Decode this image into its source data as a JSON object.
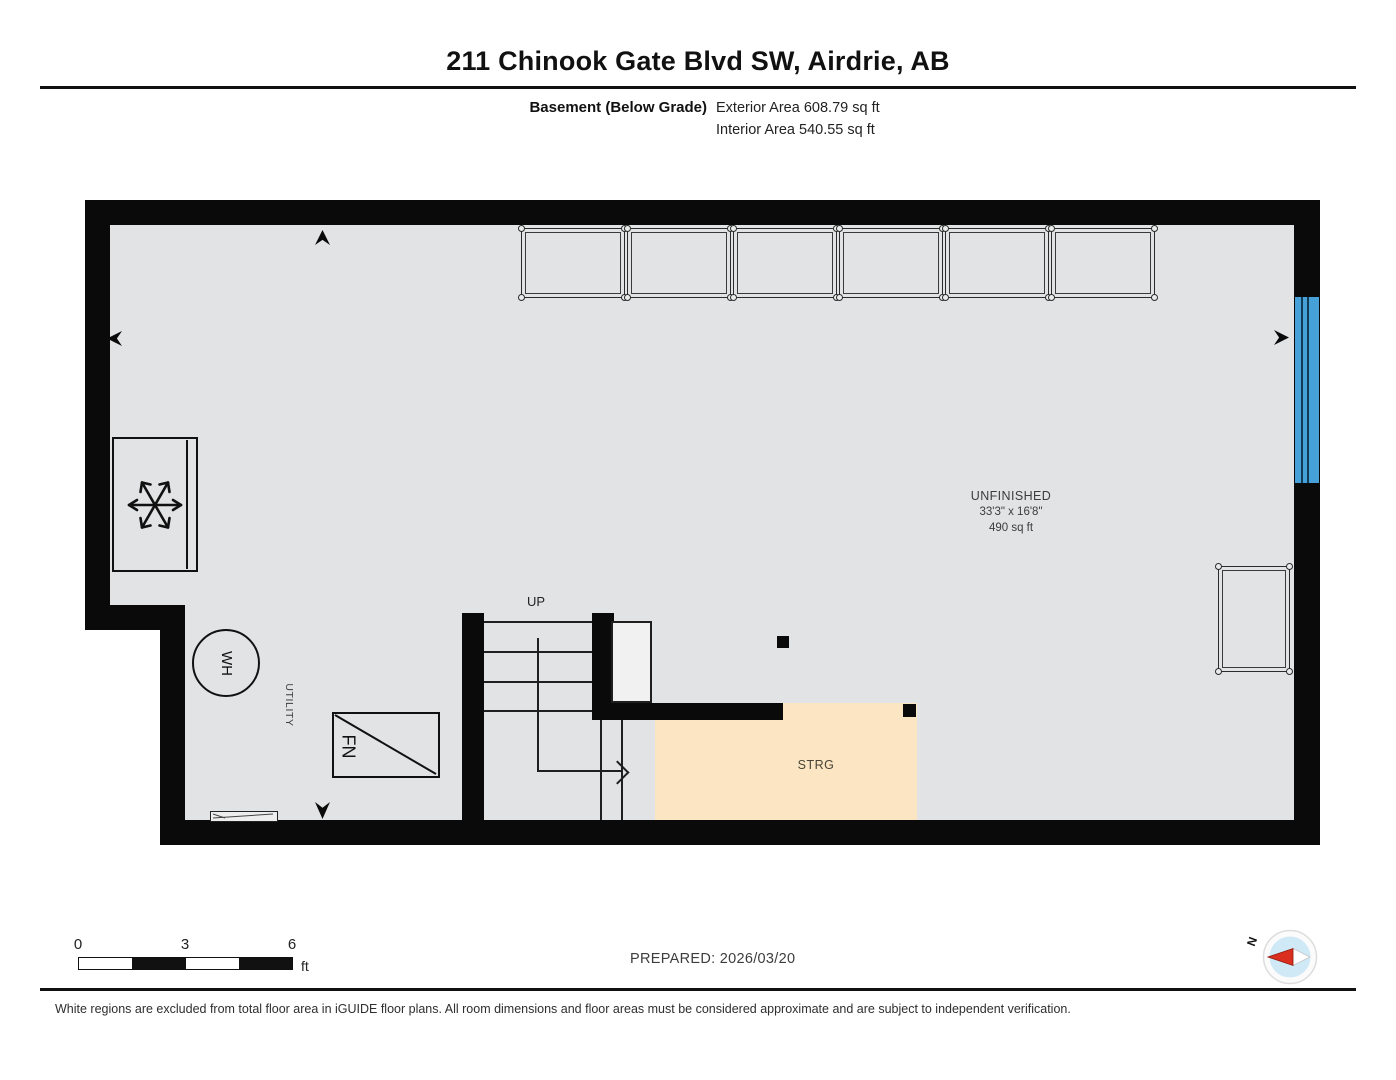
{
  "header": {
    "title": "211 Chinook Gate Blvd SW, Airdrie, AB",
    "floor_label": "Basement (Below Grade)",
    "exterior_area": "Exterior Area 608.79 sq ft",
    "interior_area": "Interior Area 540.55 sq ft"
  },
  "plan": {
    "rooms": [
      {
        "name": "unfinished",
        "label": "UNFINISHED",
        "dimensions": "33'3\" x 16'8\"",
        "area": "490 sq ft"
      },
      {
        "name": "storage",
        "label": "STRG"
      },
      {
        "name": "utility",
        "label": "UTILITY"
      }
    ],
    "stairs": {
      "up_label": "UP"
    },
    "fixtures": {
      "water_heater": "WH",
      "furnace": "FN"
    },
    "storage_rack_count": 6,
    "colors": {
      "floor": "#e2e3e4",
      "storage_fill": "#fbe5c3",
      "wall": "#0a0a0a",
      "window_blue": "#46a1d8"
    }
  },
  "scale_bar": {
    "tick_0": "0",
    "tick_3": "3",
    "tick_6": "6",
    "unit": "ft"
  },
  "footer": {
    "prepared": "PREPARED: 2026/03/20",
    "compass_north": "N",
    "disclaimer": "White regions are excluded from total floor area in iGUIDE floor plans. All room dimensions and floor areas must be considered approximate and are subject to independent verification."
  }
}
